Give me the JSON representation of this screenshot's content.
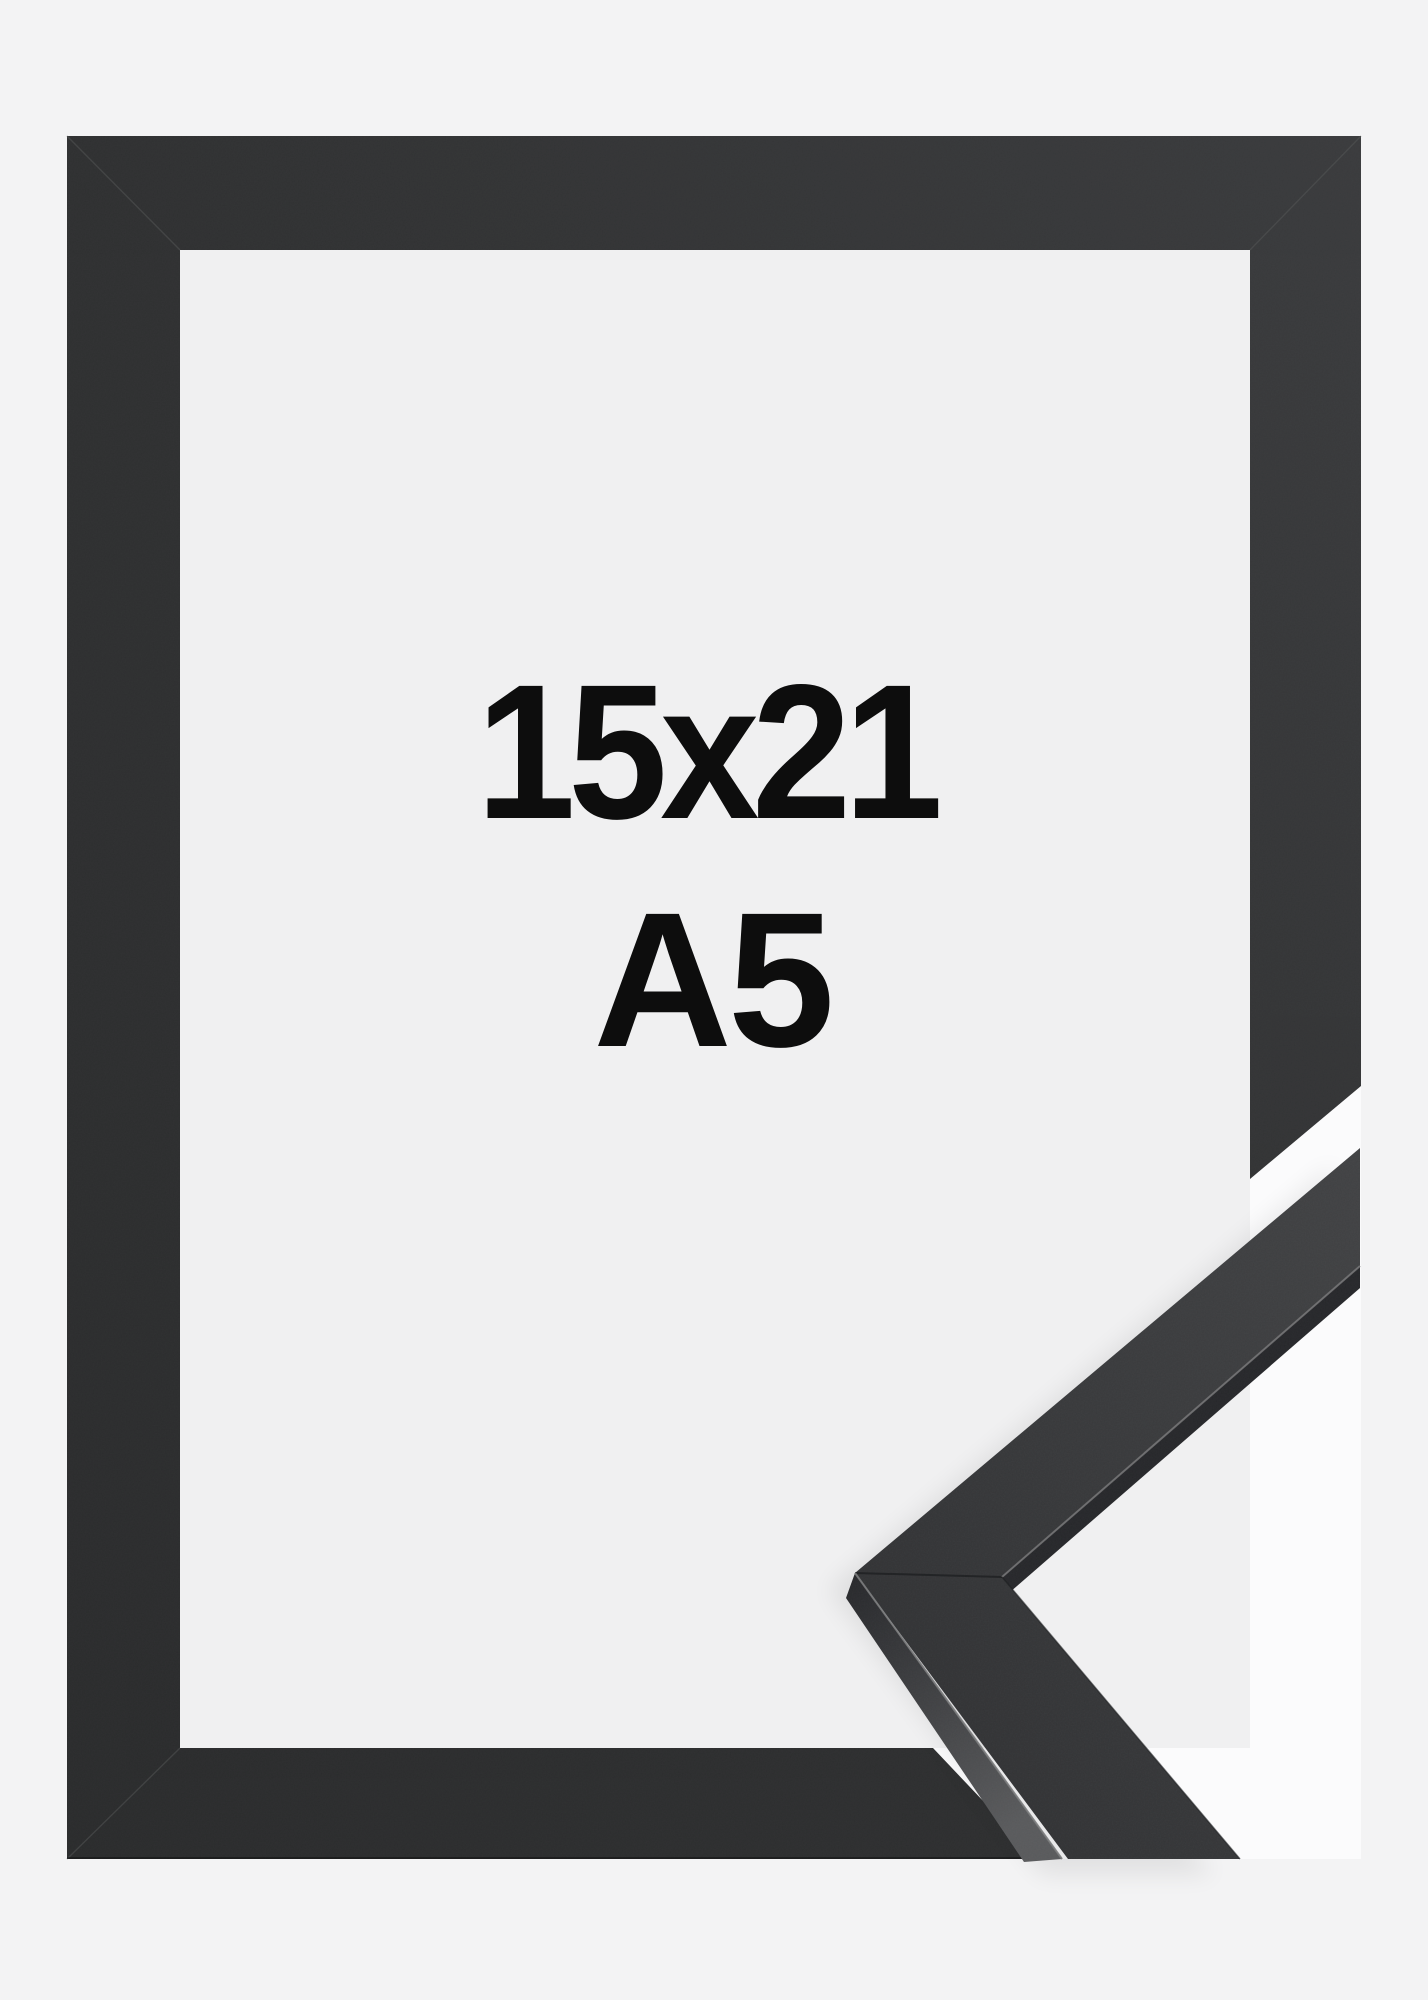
{
  "frame": {
    "size_label": "15x21",
    "format_label": "A5"
  },
  "colors": {
    "page_bg": "#f3f3f4",
    "opening_bg": "#f0f0f1",
    "cutout_bg": "#fbfbfc",
    "frame_dark": "#2a2b2c",
    "frame_mid": "#2f3031",
    "frame_light": "#3a3b3d",
    "sample_face_dark": "#2e2f31",
    "sample_face_light": "#414244",
    "sample_side_dark": "#26272a",
    "sample_side_light": "#595a5c",
    "edge_highlight": "#7a7b7c",
    "seam_line": "#565758",
    "text": "#0d0d0d"
  }
}
